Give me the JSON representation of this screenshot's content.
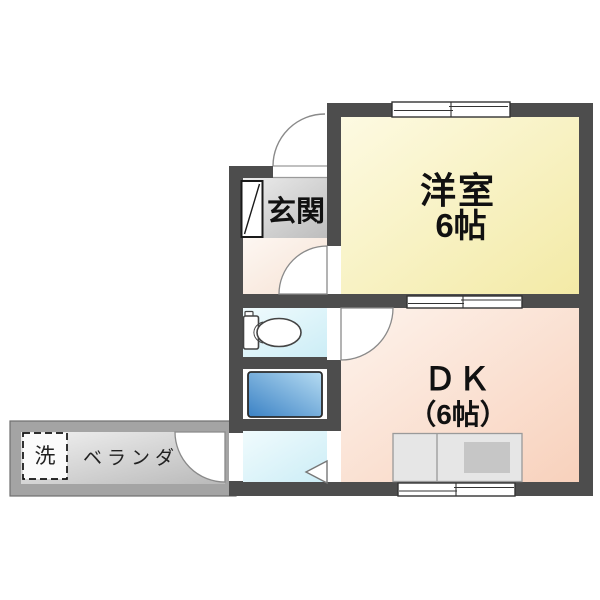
{
  "floor_plan": {
    "western_room": {
      "label": "洋室",
      "size": "6帖"
    },
    "dining_kitchen": {
      "label": "ＤＫ",
      "size": "（6帖）"
    },
    "entrance": {
      "label": "玄関"
    },
    "veranda": {
      "label": "ベランダ"
    },
    "laundry": {
      "label": "洗"
    },
    "colors": {
      "wall": "#4d4d4d",
      "western_room_fill": "#f6eeb4",
      "dining_kitchen_fill": "#f9d6c2",
      "hallway_fill": "#f9ece2",
      "entrance_fill": "#d4d4d4",
      "wet_area_fill": "#dcf3fa",
      "bathtub_fill": "#4c8fcc",
      "veranda_frame": "#a4a4a4",
      "veranda_floor": "#d8d8d8",
      "kitchen_counter_fill": "#e6e6e6",
      "window_stroke": "#333333",
      "door_arc_stroke": "#8a8a8a"
    }
  }
}
